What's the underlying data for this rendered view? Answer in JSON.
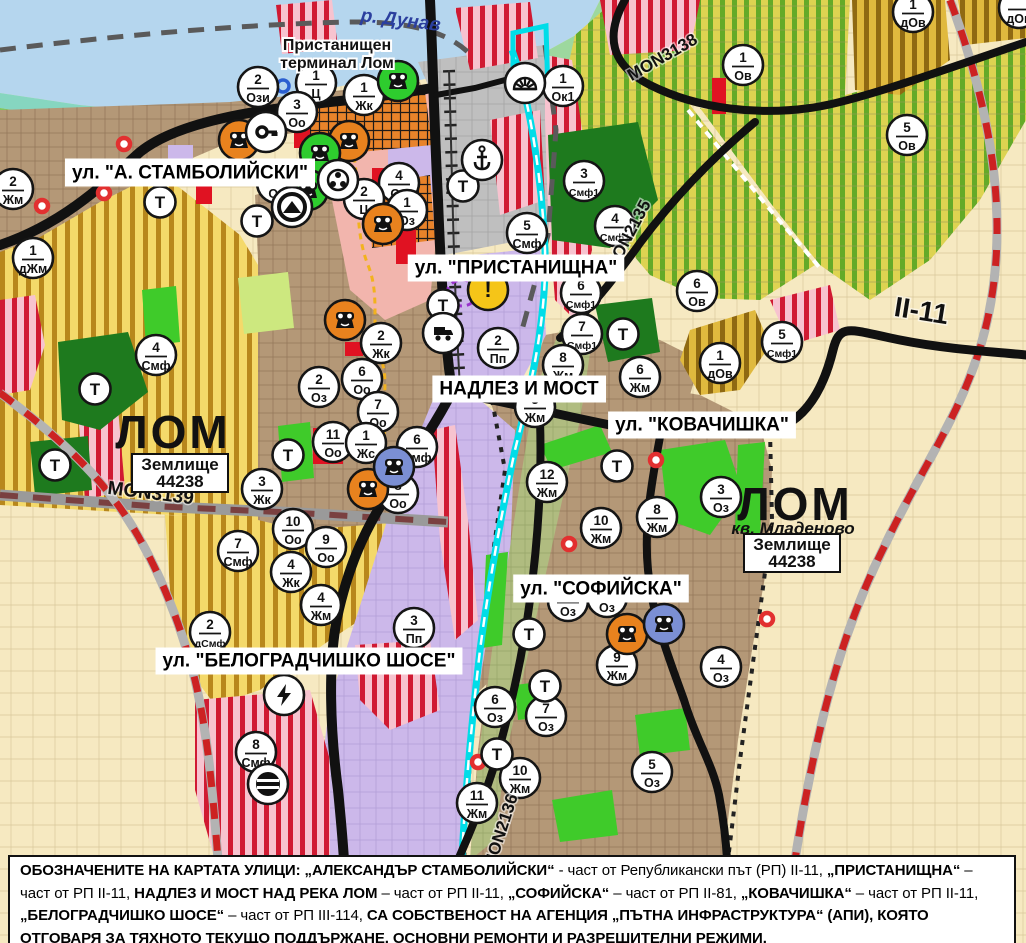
{
  "map": {
    "water_label": "р. Дунав",
    "port_terminal_label": [
      "Пристанищен",
      "терминал Лом"
    ],
    "street_labels": [
      {
        "text": "ул. \"А. СТАМБОЛИЙСКИ\"",
        "x": 190,
        "y": 172
      },
      {
        "text": "ул. \"ПРИСТАНИЩНА\"",
        "x": 516,
        "y": 267
      },
      {
        "text": "НАДЛЕЗ И МОСТ",
        "x": 519,
        "y": 388
      },
      {
        "text": "ул. \"КОВАЧИШКА\"",
        "x": 702,
        "y": 424
      },
      {
        "text": "ул. \"СОФИЙСКА\"",
        "x": 601,
        "y": 588
      },
      {
        "text": "ул. \"БЕЛОГРАДЧИШКО ШОСЕ\"",
        "x": 309,
        "y": 660
      }
    ],
    "road_labels": [
      {
        "text": "MON3138",
        "x": 665,
        "y": 62,
        "rot": -30,
        "size": 17
      },
      {
        "text": "MON2135",
        "x": 633,
        "y": 238,
        "rot": -62,
        "size": 17
      },
      {
        "text": "MON3139",
        "x": 150,
        "y": 499,
        "rot": 7,
        "size": 19
      },
      {
        "text": "MON2136",
        "x": 506,
        "y": 833,
        "rot": -72,
        "size": 17
      },
      {
        "text": "II-11",
        "x": 920,
        "y": 320,
        "rot": 9,
        "size": 28
      }
    ],
    "area_labels": [
      {
        "text": "ЛОМ",
        "x": 173,
        "y": 448,
        "size": 46
      },
      {
        "text": "ЛОМ",
        "x": 795,
        "y": 520,
        "size": 46
      }
    ],
    "district_label": {
      "text": "кв. Младеново",
      "x": 793,
      "y": 534
    },
    "cadastre_boxes": [
      {
        "lines": [
          "Землище",
          "44238"
        ],
        "x": 180,
        "y": 471
      },
      {
        "lines": [
          "Землище",
          "44238"
        ],
        "x": 792,
        "y": 551
      }
    ],
    "zone_markers": [
      {
        "n": "2",
        "c": "Ози",
        "x": 258,
        "y": 87
      },
      {
        "n": "1",
        "c": "Ц",
        "x": 316,
        "y": 83
      },
      {
        "n": "3",
        "c": "Оо",
        "x": 297,
        "y": 112
      },
      {
        "n": "1",
        "c": "Жк",
        "x": 364,
        "y": 95
      },
      {
        "n": "",
        "c": "Оо",
        "x": 277,
        "y": 183
      },
      {
        "n": "4",
        "c": "Оо",
        "x": 399,
        "y": 183
      },
      {
        "n": "2",
        "c": "Ц",
        "x": 364,
        "y": 199
      },
      {
        "n": "1",
        "c": "Оз",
        "x": 407,
        "y": 210
      },
      {
        "n": "2",
        "c": "Жм",
        "x": 13,
        "y": 189
      },
      {
        "n": "1",
        "c": "дЖм",
        "x": 33,
        "y": 258
      },
      {
        "n": "4",
        "c": "Смф",
        "x": 156,
        "y": 355
      },
      {
        "n": "1",
        "c": "Ок1",
        "x": 563,
        "y": 86
      },
      {
        "n": "3",
        "c": "Смф1",
        "x": 584,
        "y": 181
      },
      {
        "n": "5",
        "c": "Смф",
        "x": 527,
        "y": 233
      },
      {
        "n": "4",
        "c": "Смф1",
        "x": 615,
        "y": 226
      },
      {
        "n": "2",
        "c": "Пп",
        "x": 498,
        "y": 348
      },
      {
        "n": "6",
        "c": "Смф1",
        "x": 581,
        "y": 293
      },
      {
        "n": "7",
        "c": "Смф1",
        "x": 582,
        "y": 334
      },
      {
        "n": "6",
        "c": "Ов",
        "x": 697,
        "y": 291
      },
      {
        "n": "1",
        "c": "дОв",
        "x": 720,
        "y": 363
      },
      {
        "n": "5",
        "c": "Смф1",
        "x": 782,
        "y": 342
      },
      {
        "n": "1",
        "c": "Ов",
        "x": 743,
        "y": 65
      },
      {
        "n": "1",
        "c": "дОв",
        "x": 913,
        "y": 12
      },
      {
        "n": "5",
        "c": "Ов",
        "x": 907,
        "y": 135
      },
      {
        "n": "",
        "c": "дОв",
        "x": 1019,
        "y": 8
      },
      {
        "n": "2",
        "c": "Оз",
        "x": 319,
        "y": 387
      },
      {
        "n": "2",
        "c": "Жк",
        "x": 381,
        "y": 343
      },
      {
        "n": "6",
        "c": "Оо",
        "x": 362,
        "y": 379
      },
      {
        "n": "7",
        "c": "Оо",
        "x": 378,
        "y": 412
      },
      {
        "n": "11",
        "c": "Оо",
        "x": 333,
        "y": 442
      },
      {
        "n": "1",
        "c": "Жс",
        "x": 366,
        "y": 443
      },
      {
        "n": "6",
        "c": "Смф",
        "x": 417,
        "y": 447
      },
      {
        "n": "8",
        "c": "Оо",
        "x": 398,
        "y": 493
      },
      {
        "n": "3",
        "c": "Жк",
        "x": 262,
        "y": 489
      },
      {
        "n": "7",
        "c": "Смф",
        "x": 238,
        "y": 551
      },
      {
        "n": "10",
        "c": "Оо",
        "x": 293,
        "y": 529
      },
      {
        "n": "9",
        "c": "Оо",
        "x": 326,
        "y": 547
      },
      {
        "n": "4",
        "c": "Жк",
        "x": 291,
        "y": 572
      },
      {
        "n": "4",
        "c": "Жм",
        "x": 321,
        "y": 605
      },
      {
        "n": "2",
        "c": "дСмф",
        "x": 210,
        "y": 632
      },
      {
        "n": "3",
        "c": "Пп",
        "x": 414,
        "y": 628
      },
      {
        "n": "8",
        "c": "Смф",
        "x": 256,
        "y": 752
      },
      {
        "n": "8",
        "c": "Жм",
        "x": 563,
        "y": 365
      },
      {
        "n": "6",
        "c": "Жм",
        "x": 640,
        "y": 377
      },
      {
        "n": "5",
        "c": "Жм",
        "x": 535,
        "y": 407
      },
      {
        "n": "12",
        "c": "Жм",
        "x": 547,
        "y": 482
      },
      {
        "n": "3",
        "c": "Оз",
        "x": 721,
        "y": 497
      },
      {
        "n": "8",
        "c": "Жм",
        "x": 657,
        "y": 517
      },
      {
        "n": "10",
        "c": "Жм",
        "x": 601,
        "y": 528
      },
      {
        "n": "",
        "c": "Оз",
        "x": 568,
        "y": 601
      },
      {
        "n": "",
        "c": "Оз",
        "x": 607,
        "y": 597
      },
      {
        "n": "9",
        "c": "Жм",
        "x": 617,
        "y": 665
      },
      {
        "n": "4",
        "c": "Оз",
        "x": 721,
        "y": 667
      },
      {
        "n": "6",
        "c": "Оз",
        "x": 495,
        "y": 707
      },
      {
        "n": "7",
        "c": "Оз",
        "x": 546,
        "y": 716
      },
      {
        "n": "10",
        "c": "Жм",
        "x": 520,
        "y": 778
      },
      {
        "n": "11",
        "c": "Жм",
        "x": 477,
        "y": 803
      },
      {
        "n": "5",
        "c": "Оз",
        "x": 652,
        "y": 772
      }
    ],
    "t_markers": [
      [
        160,
        202
      ],
      [
        257,
        221
      ],
      [
        463,
        186
      ],
      [
        443,
        305
      ],
      [
        95,
        389
      ],
      [
        55,
        465
      ],
      [
        288,
        455
      ],
      [
        623,
        334
      ],
      [
        617,
        466
      ],
      [
        529,
        634
      ],
      [
        545,
        686
      ],
      [
        497,
        754
      ]
    ],
    "t_label": "Т",
    "icon_markers": [
      {
        "t": "monument-orange",
        "x": 239,
        "y": 140
      },
      {
        "t": "monument-orange",
        "x": 349,
        "y": 141
      },
      {
        "t": "monument-orange",
        "x": 383,
        "y": 224
      },
      {
        "t": "monument-orange",
        "x": 345,
        "y": 320
      },
      {
        "t": "monument-orange",
        "x": 368,
        "y": 489
      },
      {
        "t": "monument-orange",
        "x": 627,
        "y": 634
      },
      {
        "t": "monument-green",
        "x": 398,
        "y": 81
      },
      {
        "t": "monument-green",
        "x": 320,
        "y": 153
      },
      {
        "t": "monument-green",
        "x": 308,
        "y": 190
      },
      {
        "t": "monument-blue",
        "x": 394,
        "y": 467
      },
      {
        "t": "monument-blue",
        "x": 664,
        "y": 624
      },
      {
        "t": "key",
        "x": 266,
        "y": 132
      },
      {
        "t": "people",
        "x": 338,
        "y": 180
      },
      {
        "t": "tunnel",
        "x": 292,
        "y": 207
      },
      {
        "t": "anchor",
        "x": 482,
        "y": 160
      },
      {
        "t": "harbor",
        "x": 525,
        "y": 83
      },
      {
        "t": "truck",
        "x": 443,
        "y": 333
      },
      {
        "t": "warning",
        "x": 488,
        "y": 290
      },
      {
        "t": "lightning",
        "x": 284,
        "y": 695
      },
      {
        "t": "railcross",
        "x": 268,
        "y": 784
      }
    ],
    "red_dots": [
      [
        42,
        206
      ],
      [
        104,
        193
      ],
      [
        124,
        144
      ],
      [
        656,
        460
      ],
      [
        569,
        544
      ],
      [
        478,
        762
      ],
      [
        767,
        619
      ]
    ],
    "blue_rings": [
      [
        283,
        86
      ]
    ],
    "palette": {
      "water": "#b5d6ee",
      "marker_orange": "#e8821e",
      "marker_green": "#2ecc2e",
      "marker_blue": "#7b8fd4",
      "warning_yellow": "#f5c518",
      "road_black": "#111111",
      "railway_red": "#cc2222",
      "channel_cyan": "#00dde8",
      "zone_yellow": "#f4d96a",
      "zone_green_stripe": "#64aa28",
      "zone_purple": "#ccb8ea",
      "zone_brown": "#b49877",
      "zone_pink_stripe": "#d01a32",
      "label_blue": "#2b3f9e"
    }
  },
  "caption": {
    "segments": [
      {
        "bold": true,
        "text": "ОБОЗНАЧЕНИТЕ НА КАРТАТА УЛИЦИ: „АЛЕКСАНДЪР СТАМБОЛИЙСКИ“"
      },
      {
        "bold": false,
        "text": " - част от Републикански път (РП) II-11, "
      },
      {
        "bold": true,
        "text": "„ПРИСТАНИЩНА“"
      },
      {
        "bold": false,
        "text": " – част от РП II-11, "
      },
      {
        "bold": true,
        "text": "НАДЛЕЗ И МОСТ НАД РЕКА ЛОМ"
      },
      {
        "bold": false,
        "text": " – част от РП II-11, "
      },
      {
        "bold": true,
        "text": "„СОФИЙСКА“"
      },
      {
        "bold": false,
        "text": " – част от РП II-81, "
      },
      {
        "bold": true,
        "text": "„КОВАЧИШКА“"
      },
      {
        "bold": false,
        "text": " – част от РП II-11, "
      },
      {
        "bold": true,
        "text": "„БЕЛОГРАДЧИШКО ШОСЕ“"
      },
      {
        "bold": false,
        "text": " – част от РП III-114, "
      },
      {
        "bold": true,
        "text": "СА СОБСТВЕНОСТ НА АГЕНЦИЯ „ПЪТНА ИНФРАСТРУКТУРА“ (АПИ), КОЯТО ОТГОВАРЯ ЗА ТЯХНОТО ТЕКУЩО ПОДДЪРЖАНЕ, ОСНОВНИ РЕМОНТИ И РАЗРЕШИТЕЛНИ РЕЖИМИ."
      }
    ]
  }
}
